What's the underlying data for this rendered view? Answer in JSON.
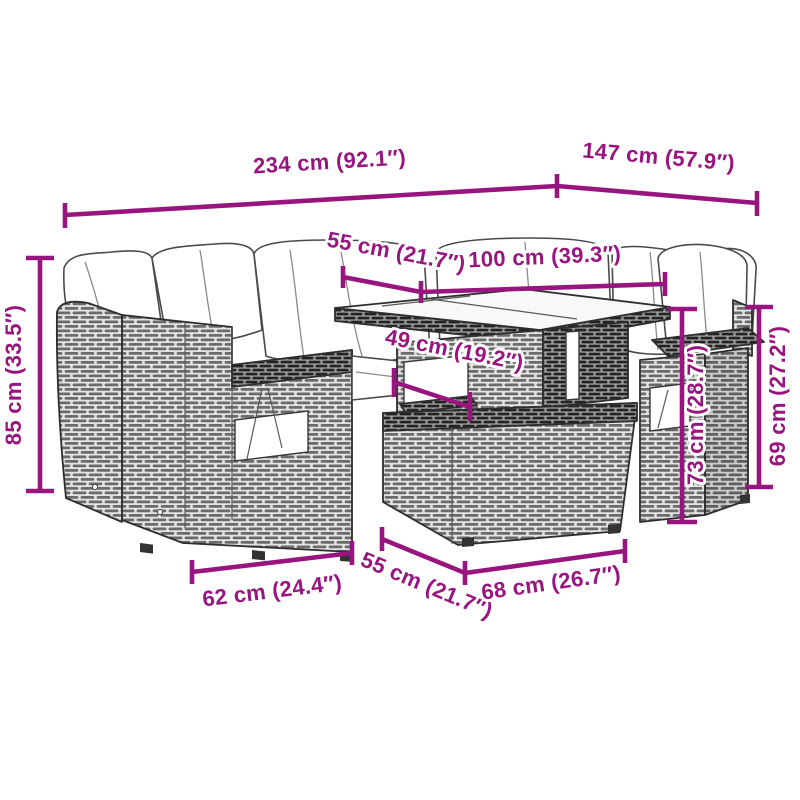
{
  "page": {
    "kind": "product-dimension-diagram",
    "background_color": "#ffffff",
    "accent_color": "#981580",
    "line_art_color": "#2e2e2e"
  },
  "product": {
    "name": "poly-rattan-garden-lounge-set",
    "parts": [
      "corner-sofa",
      "back-sofa-section",
      "garden-table",
      "ottoman",
      "armrest-chair",
      "seat-cushions"
    ]
  },
  "dims": {
    "d234": {
      "label": "234 cm (92.1″)"
    },
    "d147": {
      "label": "147 cm (57.9″)"
    },
    "d55t": {
      "label": "55 cm (21.7″)"
    },
    "d100": {
      "label": "100 cm (39.3″)"
    },
    "d49": {
      "label": "49 cm (19.2″)"
    },
    "d85": {
      "label": "85 cm (33.5″)"
    },
    "d73": {
      "label": "73 cm (28.7″)"
    },
    "d69": {
      "label": "69 cm (27.2″)"
    },
    "d62": {
      "label": "62 cm (24.4″)"
    },
    "d55b": {
      "label": "55 cm (21.7″)"
    },
    "d68": {
      "label": "68 cm (26.7″)"
    }
  }
}
